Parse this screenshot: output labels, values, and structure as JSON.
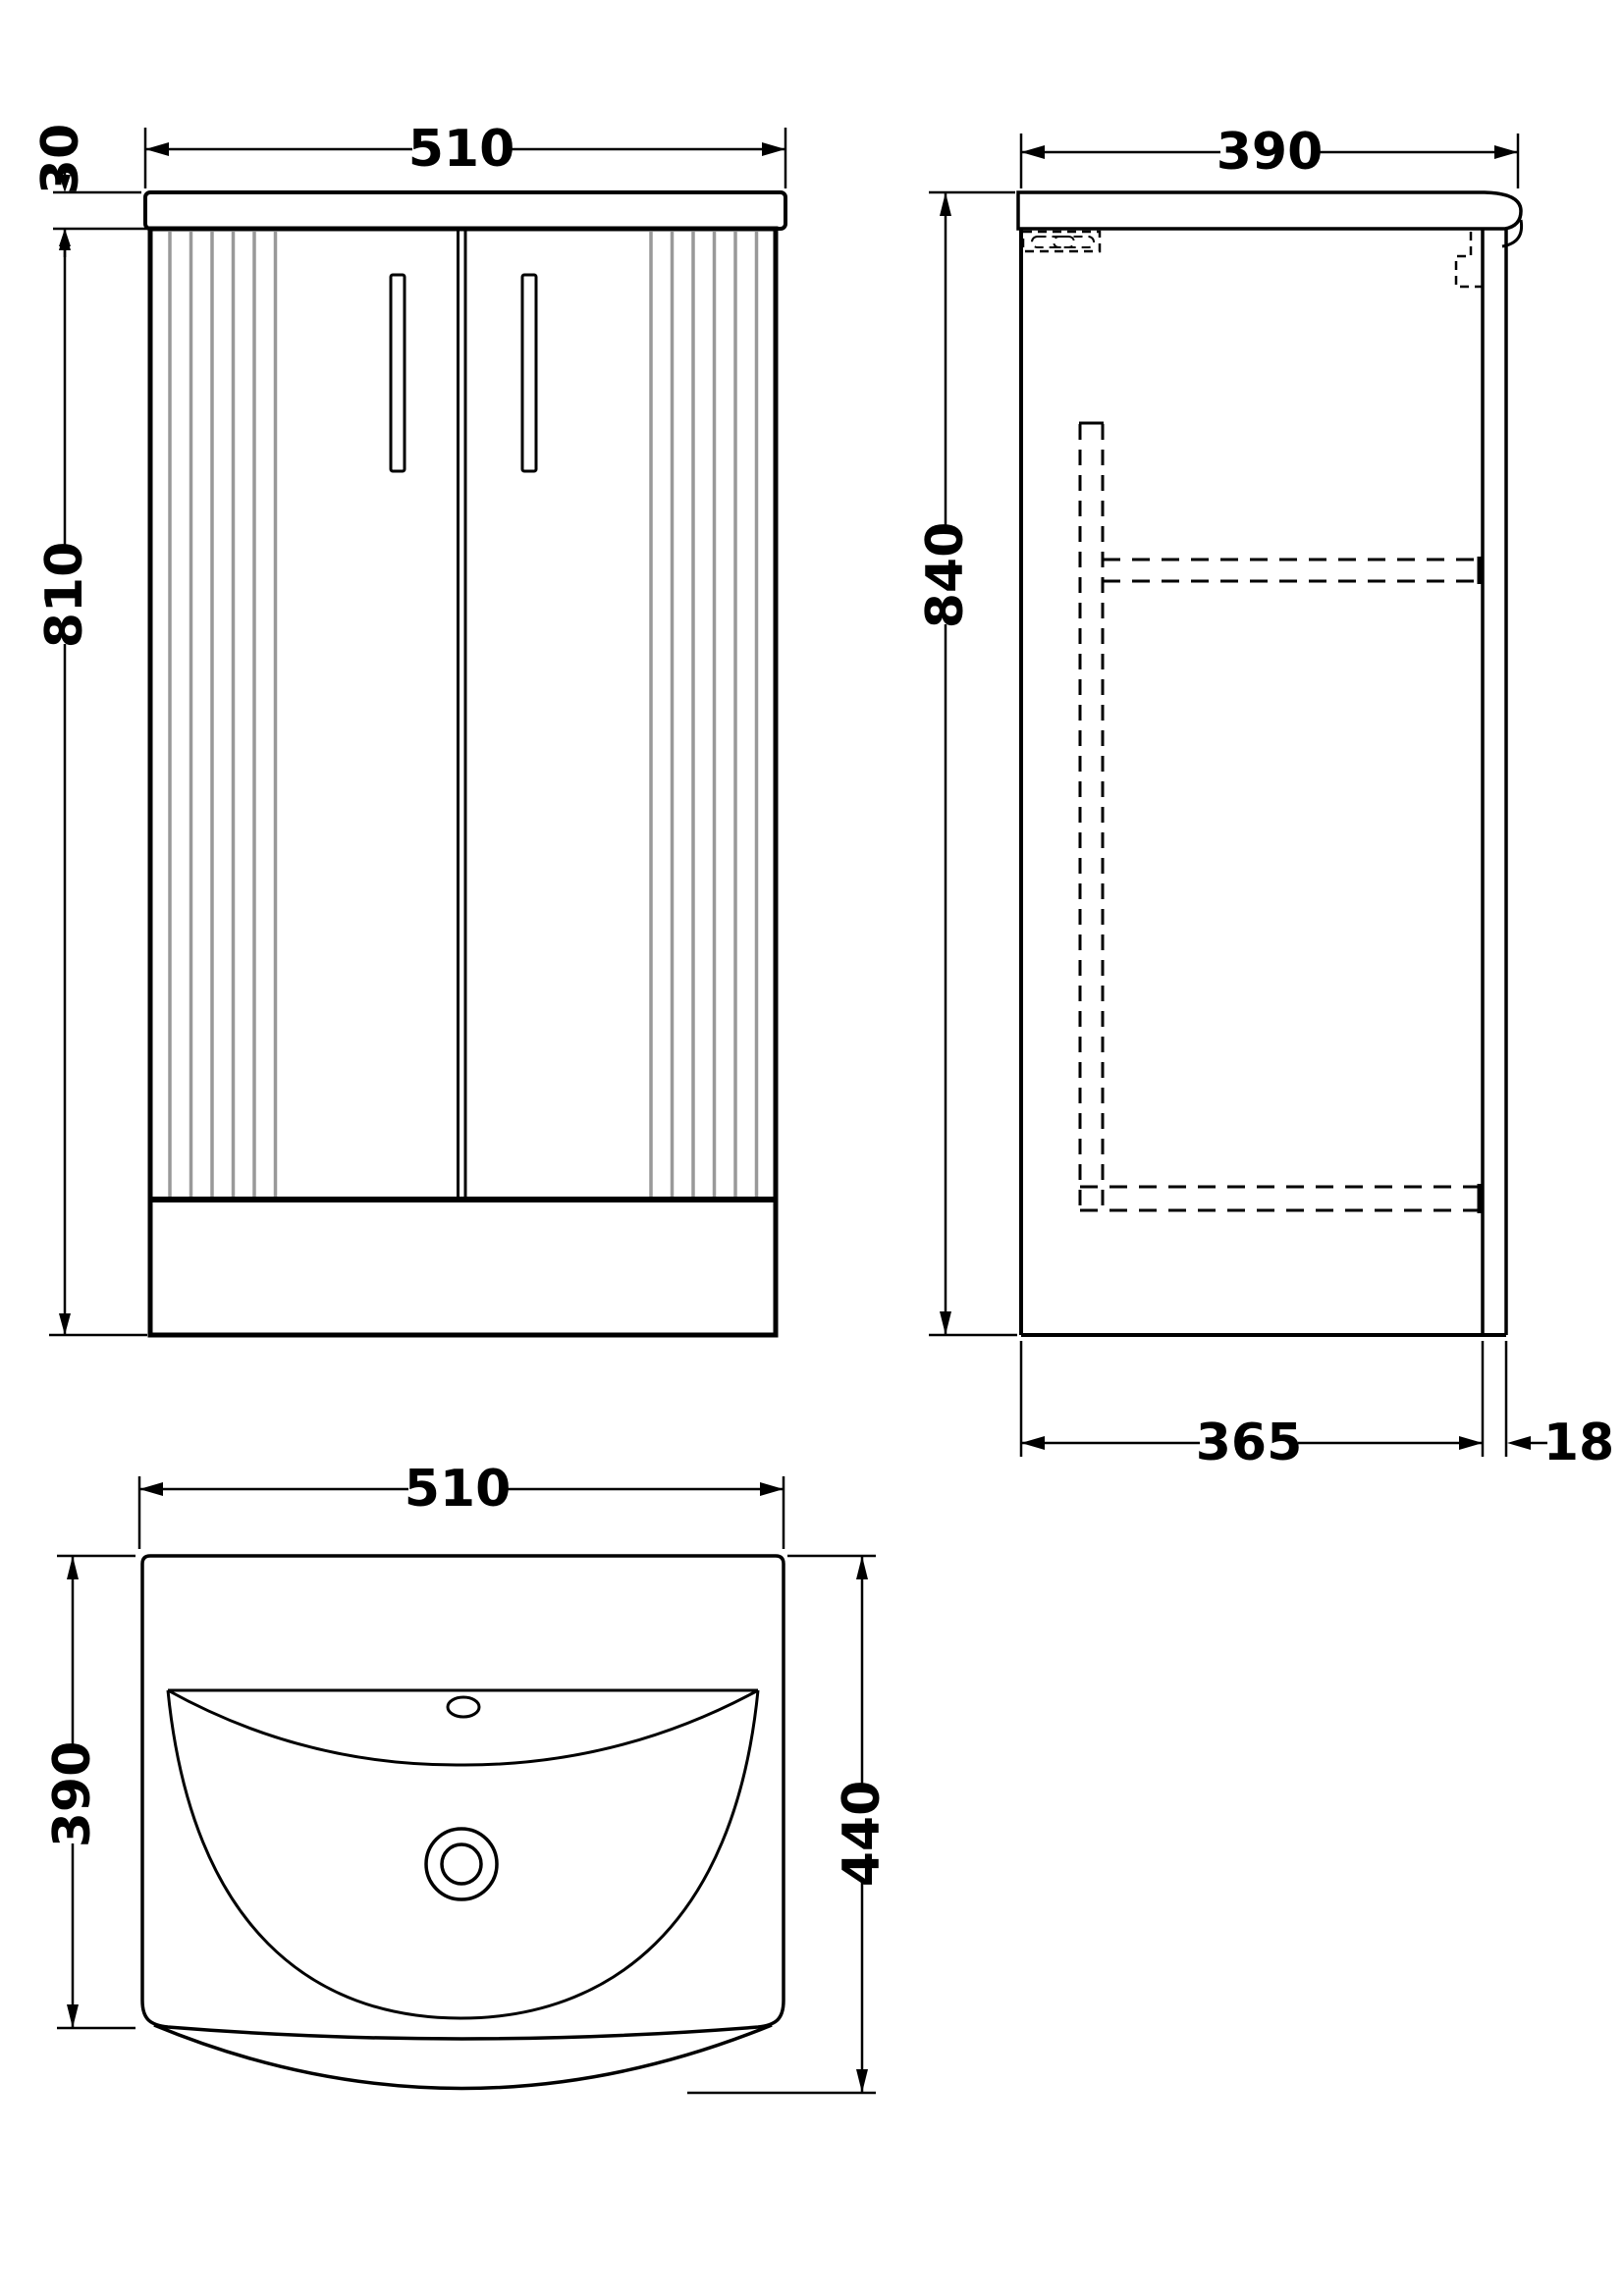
{
  "drawing": {
    "type": "vanity-unit-technical-drawing",
    "line_color": "#000000",
    "flute_color": "#999999",
    "background_color": "#ffffff",
    "front": {
      "width_label": "510",
      "counter_thickness_label": "30",
      "cabinet_height_label": "810"
    },
    "side": {
      "depth_label": "390",
      "total_height_label": "840",
      "body_depth_label": "365",
      "door_thickness_label": "18"
    },
    "plan": {
      "width_label": "510",
      "basin_depth_label": "390",
      "total_depth_label": "440"
    }
  }
}
